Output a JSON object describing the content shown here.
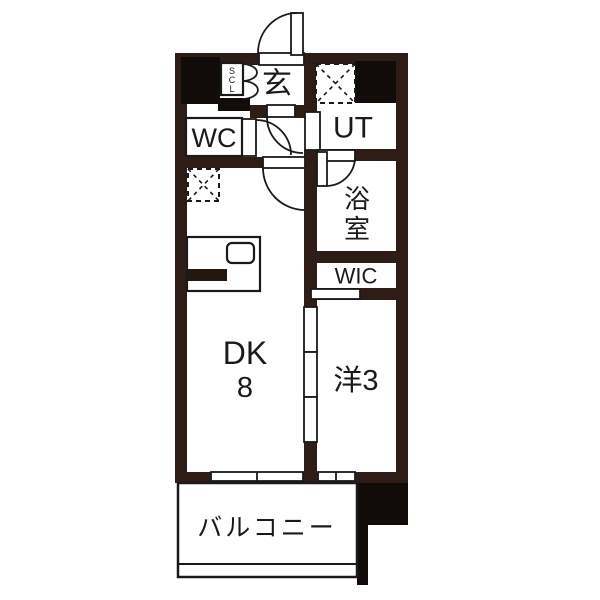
{
  "floorplan": {
    "type": "apartment-floor-plan",
    "rooms": {
      "genkan": {
        "label": "玄"
      },
      "shoe_closet": {
        "letters": [
          "S",
          "C",
          "L"
        ]
      },
      "wc": {
        "label": "WC"
      },
      "utility": {
        "label": "UT"
      },
      "bath": {
        "chars": [
          "浴",
          "室"
        ]
      },
      "wic": {
        "label": "WIC"
      },
      "dining_kitchen": {
        "label": "DK",
        "size": "8"
      },
      "western_room": {
        "label": "洋3"
      },
      "balcony": {
        "label": "バルコニー"
      }
    },
    "colors": {
      "wall": "#2e1d16",
      "pillar_black": "#110c09",
      "line": "#1a1a1a",
      "floor": "#ffffff"
    }
  }
}
